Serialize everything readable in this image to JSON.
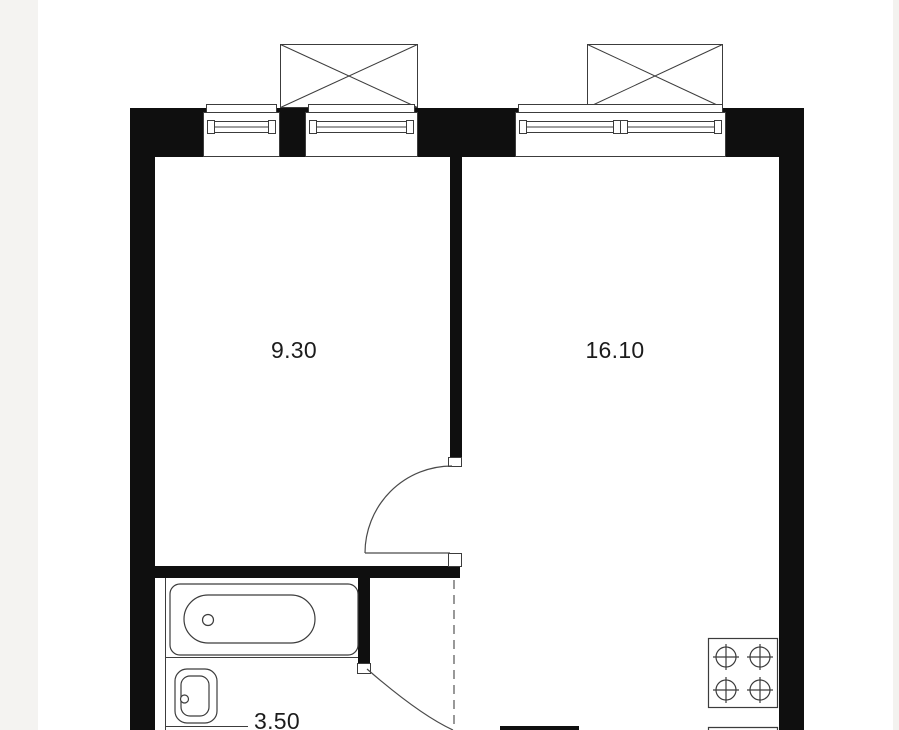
{
  "page": {
    "background": "#ffffff",
    "gutter_color": "#f4f3f1"
  },
  "plan": {
    "type": "apartment-floor-plan",
    "rooms": [
      {
        "id": "room-left",
        "area_label": "9.30"
      },
      {
        "id": "room-right",
        "area_label": "16.10"
      },
      {
        "id": "bathroom",
        "area_label": "3.50"
      }
    ],
    "fixtures": [
      "bathtub",
      "wash-basin",
      "stove-4-burner",
      "window-left",
      "window-middle",
      "window-right",
      "vent-shaft-left",
      "vent-shaft-right",
      "door-swing-room",
      "door-swing-bathroom",
      "opening-dashed-line"
    ],
    "colors": {
      "wall": "#0f0f0f",
      "line": "#444444",
      "label": "#1c1c1c"
    }
  }
}
